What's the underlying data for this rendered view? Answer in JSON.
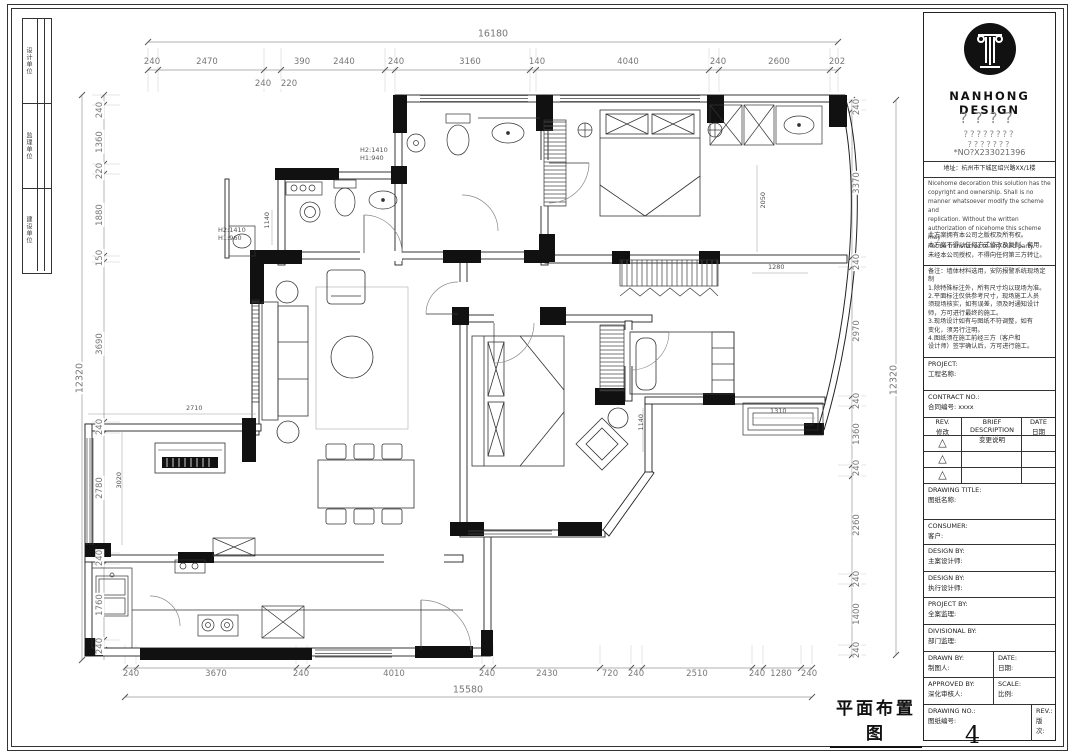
{
  "sheet": {
    "stamp_title": "平面布置图",
    "page_number": "4"
  },
  "side_strip": {
    "cells": [
      "设计单位",
      "监理单位",
      "建设单位"
    ]
  },
  "title_block": {
    "brand": "NANHONG   DESIGN",
    "q1": "????",
    "q2": "????????",
    "q3": "???????",
    "serial": "*NO?X233021396",
    "address": "地址：杭州市下城区绍兴路XX/1楼",
    "disclaimer_en": "Nicehome decoration this solution has the\ncopyright and ownership. Shall is no\nmanner whatsoever modify the scheme and\nreplication. Without the written\nauthorization of nicehome this scheme may\nnot be transferred to any third party.",
    "disclaimer_cn": "此方案拥有本公司之版权及所有权。\n本方案不得以任何方式修改及复制、套用，\n未经本公司授权，不得向任何第三方转让。",
    "notes": "备注：墙体材料选用，安防报警系统现场定制\n1.除特殊标注外，所有尺寸均以现场为准。\n2.平面标注仅供参考尺寸，现场施工人员\n须现场核实，如有误差，须及时通知设计\n师，方可进行最终的施工。\n3.现场设计如有与图纸不符调整，如有\n变化，须另行注明。\n4.图纸须在施工前经三方（客户和\n设计师）签字确认后，方可进行施工。",
    "project_label": "PROJECT:",
    "project_cn": "工程名称:",
    "contract_label": "CONTRACT NO.:",
    "contract_cn": "合同编号: xxxx",
    "rev_header": {
      "c1a": "REV.",
      "c1b": "修改",
      "c2a": "BRIEF DESCRIPTION",
      "c2b": "变更说明",
      "c3a": "DATE",
      "c3b": "日期"
    },
    "rev_triangle": "△",
    "drawing_title_label": "DRAWING TITLE:",
    "drawing_title_cn": "图纸名称:",
    "consumer_label": "CONSUMER:",
    "consumer_cn": "客户:",
    "design1_label": "DESIGN BY:",
    "design1_cn": "主案设计师:",
    "design2_label": "DESIGN BY:",
    "design2_cn": "执行设计师:",
    "projectby_label": "PROJECT BY:",
    "projectby_cn": "全案监理:",
    "divisional_label": "DIVISIONAL BY:",
    "divisional_cn": "部门监理:",
    "drawn_label": "DRAWN BY:",
    "drawn_cn": "制图人:",
    "date_label": "DATE:",
    "date_cn": "日期:",
    "approved_label": "APPROVED BY:",
    "approved_cn": "深化审核人:",
    "scale_label": "SCALE:",
    "scale_cn": "比例:",
    "drawingno_label": "DRAWING NO.:",
    "drawingno_cn": "图纸编号:",
    "rev2_label": "REV.:",
    "rev2_cn": "版次:",
    "drawing_no": "4"
  },
  "dims": {
    "top": {
      "overall": "16180",
      "segments": [
        "240",
        "2470",
        "390",
        "2440",
        "240",
        "3160",
        "140",
        "4040",
        "240",
        "2600",
        "202"
      ],
      "sub_segments": [
        "240",
        "220"
      ]
    },
    "bottom": {
      "overall": "15580",
      "segments": [
        "240",
        "3670",
        "240",
        "4010",
        "240",
        "2430",
        "720",
        "240",
        "2510",
        "240",
        "1280",
        "240"
      ]
    },
    "left": {
      "overall": "12320",
      "segments": [
        "240",
        "1360",
        "220",
        "1880",
        "150",
        "3690",
        "240",
        "2780",
        "240",
        "1760",
        "240"
      ]
    },
    "right": {
      "overall": "12320",
      "segments": [
        "240",
        "3370",
        "240",
        "2970",
        "240",
        "1360",
        "240",
        "2260",
        "240",
        "1400",
        "240"
      ]
    },
    "interior": {
      "bath_top": "H2:1410\nH1:940",
      "bath_left": "H2:1410\nH1:960",
      "piano_w": "2710",
      "piano_d": "3020",
      "closet": "2050",
      "win_top": "1280",
      "bay": "1310",
      "niche": "1140",
      "laundry": "1140"
    }
  }
}
